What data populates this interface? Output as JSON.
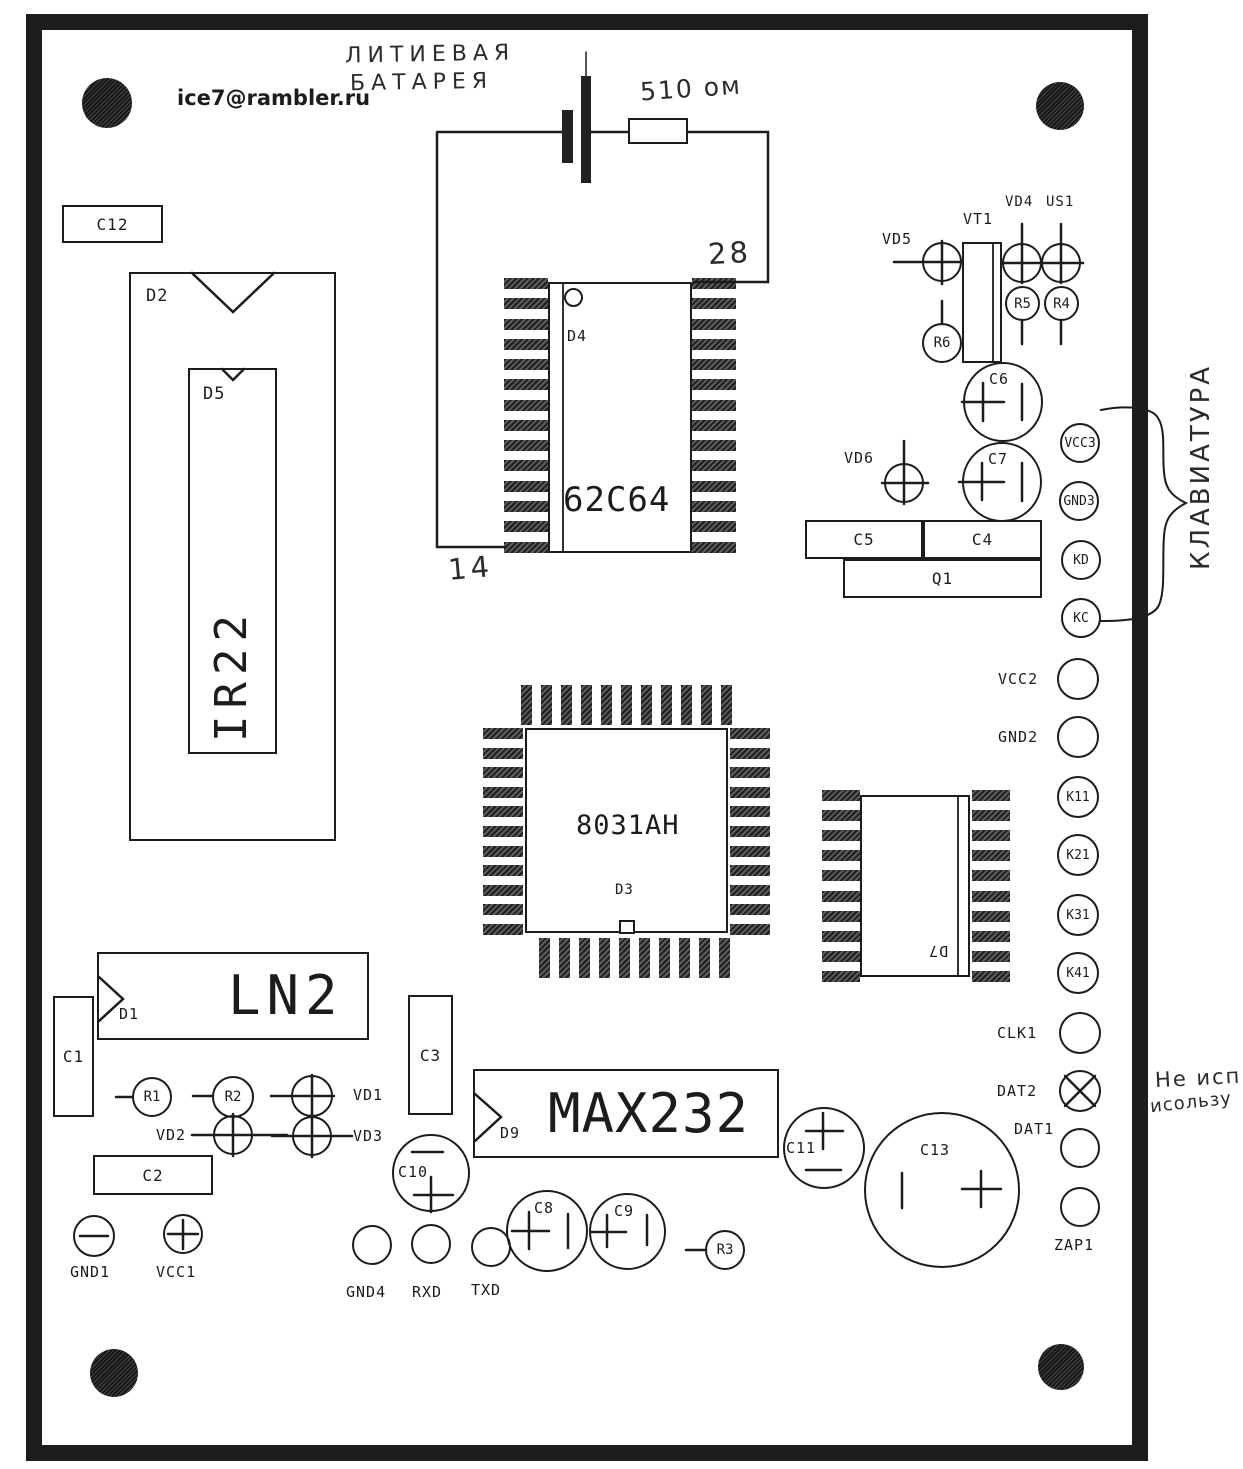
{
  "title_email": "ice7@rambler.ru",
  "handwritten": {
    "battery_line1": "ЛИТИЕВАЯ",
    "battery_line2": "БАТАРЕЯ",
    "resistor_value": "510 ом",
    "pin28": "28",
    "pin14": "14",
    "keyboard": "КЛАВИАТУРА",
    "not_used_line1": "Не исп",
    "not_used_line2": "исользу"
  },
  "big": {
    "ir22": "IR22",
    "ram": "62C64",
    "mcu": "8031AH",
    "lcd": "LN2",
    "rs232": "MAX232"
  },
  "refs": {
    "c12": "C12",
    "d2": "D2",
    "d5": "D5",
    "d4": "D4",
    "d3": "D3",
    "d7": "D7",
    "d1": "D1",
    "d9": "D9",
    "vt1": "VT1",
    "q1": "Q1",
    "vd1": "VD1",
    "vd2": "VD2",
    "vd3": "VD3",
    "vd4": "VD4",
    "vd5": "VD5",
    "vd6": "VD6",
    "us1": "US1",
    "r1": "R1",
    "r2": "R2",
    "r3": "R3",
    "r4": "R4",
    "r5": "R5",
    "r6": "R6",
    "c1": "C1",
    "c2": "C2",
    "c3": "C3",
    "c4": "C4",
    "c5": "C5",
    "c6": "C6",
    "c7": "C7",
    "c8": "C8",
    "c9": "C9",
    "c10": "C10",
    "c11": "C11",
    "c13": "C13"
  },
  "pads": {
    "vcc3": "VCC3",
    "gnd3": "GND3",
    "kd": "KD",
    "kc": "KC",
    "vcc2": "VCC2",
    "gnd2": "GND2",
    "k11": "K11",
    "k21": "K21",
    "k31": "K31",
    "k41": "K41",
    "clk1": "CLK1",
    "dat2": "DAT2",
    "dat1": "DAT1",
    "zap1": "ZAP1",
    "gnd1": "GND1",
    "vcc1": "VCC1",
    "gnd4": "GND4",
    "rxd": "RXD",
    "txd": "TXD"
  },
  "colors": {
    "ink": "#1c1c1c",
    "pad_fill": "#3c3c3c",
    "board_bg": "#ffffff"
  }
}
